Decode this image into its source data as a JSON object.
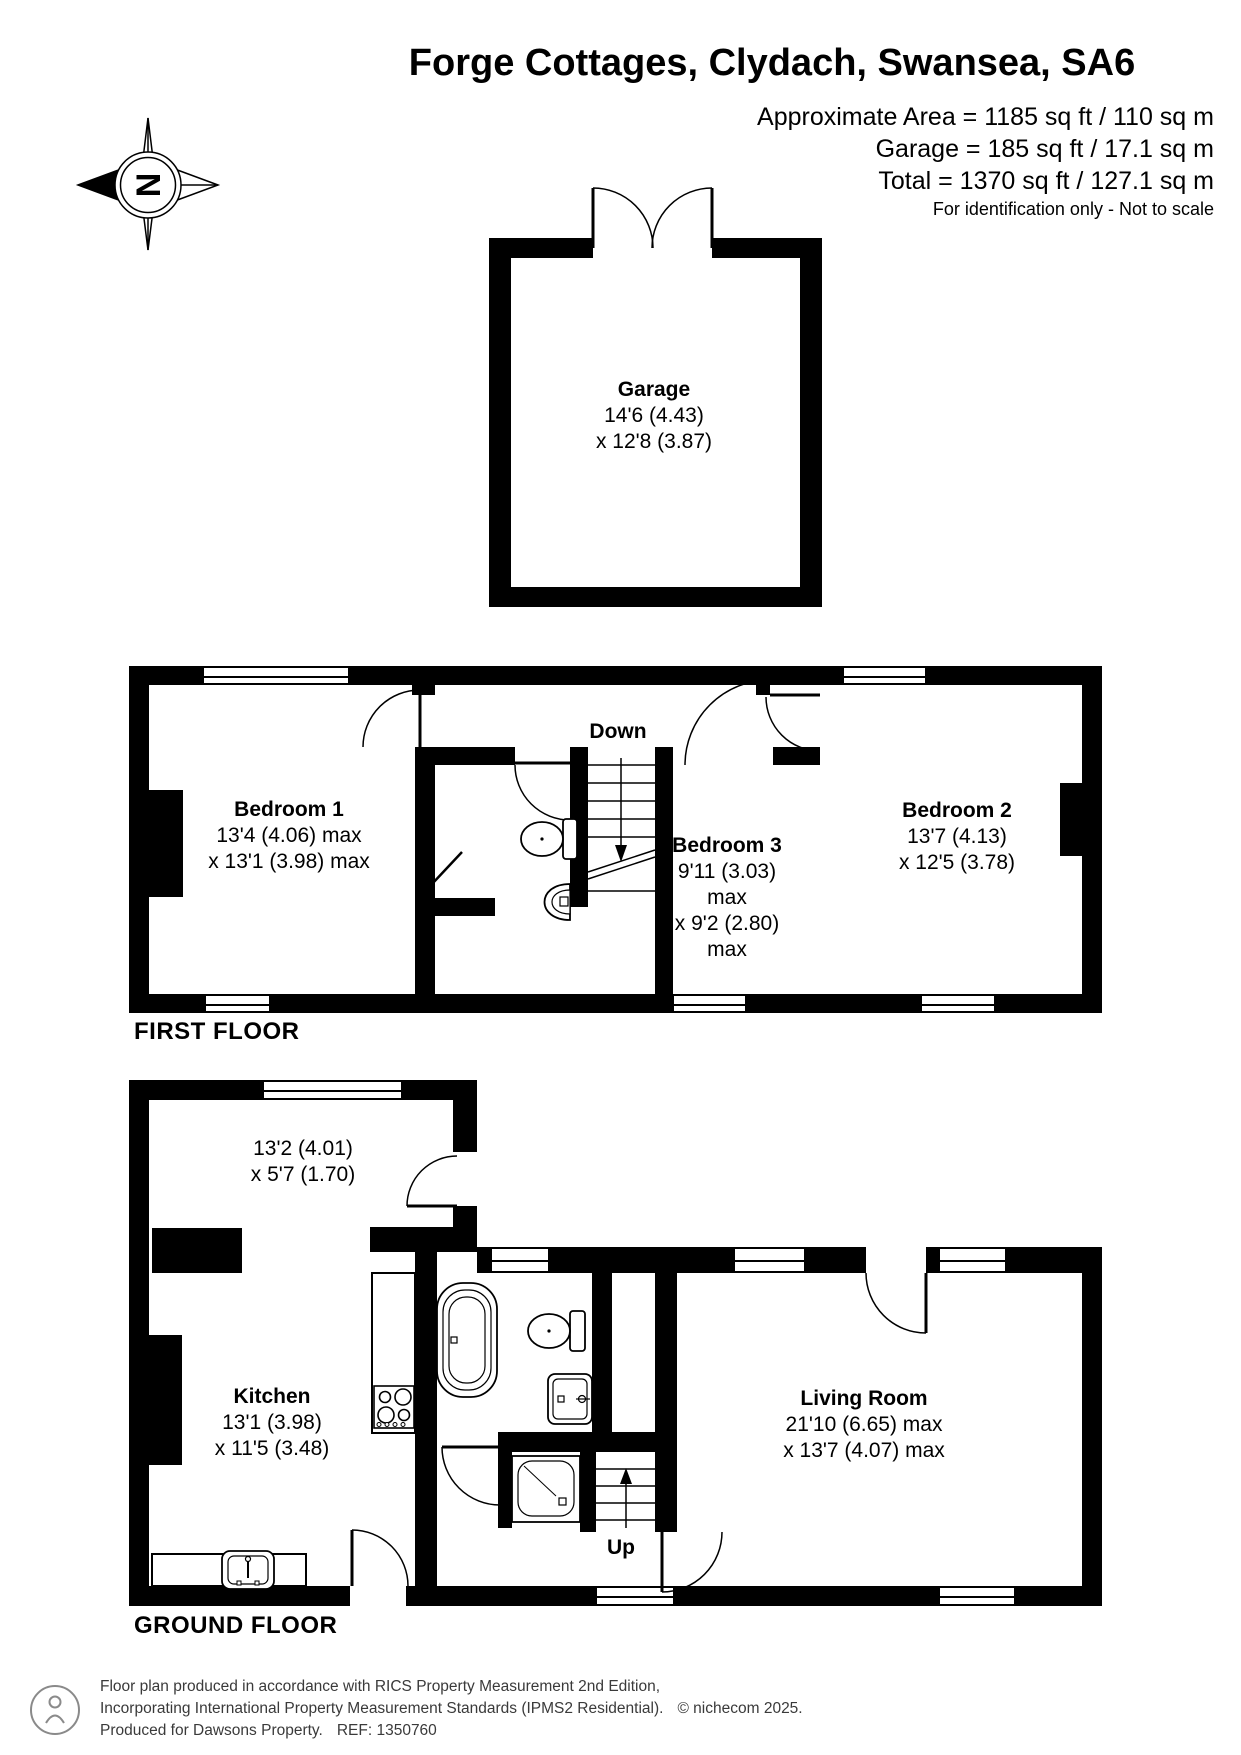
{
  "header": {
    "title": "Forge Cottages, Clydach, Swansea, SA6",
    "area_line1": "Approximate Area = 1185 sq ft / 110 sq m",
    "area_line2": "Garage = 185 sq ft / 17.1 sq m",
    "area_line3": "Total = 1370 sq ft / 127.1 sq m",
    "disclaimer": "For identification only - Not to scale"
  },
  "compass": {
    "letter": "N"
  },
  "floors": {
    "first": {
      "label": "FIRST FLOOR"
    },
    "ground": {
      "label": "GROUND FLOOR"
    }
  },
  "rooms": {
    "garage": {
      "name": "Garage",
      "dims": [
        "14'6 (4.43)",
        "x 12'8 (3.87)"
      ]
    },
    "bedroom1": {
      "name": "Bedroom 1",
      "dims": [
        "13'4 (4.06) max",
        "x 13'1 (3.98) max"
      ]
    },
    "bedroom2": {
      "name": "Bedroom 2",
      "dims": [
        "13'7 (4.13)",
        "x 12'5 (3.78)"
      ]
    },
    "bedroom3": {
      "name": "Bedroom 3",
      "dims": [
        "9'11 (3.03)",
        "max",
        "x 9'2 (2.80)",
        "max"
      ]
    },
    "hallway": {
      "dims": [
        "13'2 (4.01)",
        "x 5'7 (1.70)"
      ]
    },
    "kitchen": {
      "name": "Kitchen",
      "dims": [
        "13'1 (3.98)",
        "x 11'5 (3.48)"
      ]
    },
    "living": {
      "name": "Living Room",
      "dims": [
        "21'10 (6.65) max",
        "x 13'7 (4.07) max"
      ]
    }
  },
  "stairs": {
    "down": "Down",
    "up": "Up"
  },
  "footer": {
    "line1": "Floor plan produced in accordance with RICS Property Measurement 2nd Edition,",
    "line2": "Incorporating International Property Measurement Standards (IPMS2 Residential).",
    "copyright": "© nichecom 2025.",
    "line3": "Produced for Dawsons Property.",
    "ref": "REF: 1350760"
  },
  "colors": {
    "walls": "#000000",
    "background": "#ffffff",
    "footer_text": "#3a3a3a"
  }
}
